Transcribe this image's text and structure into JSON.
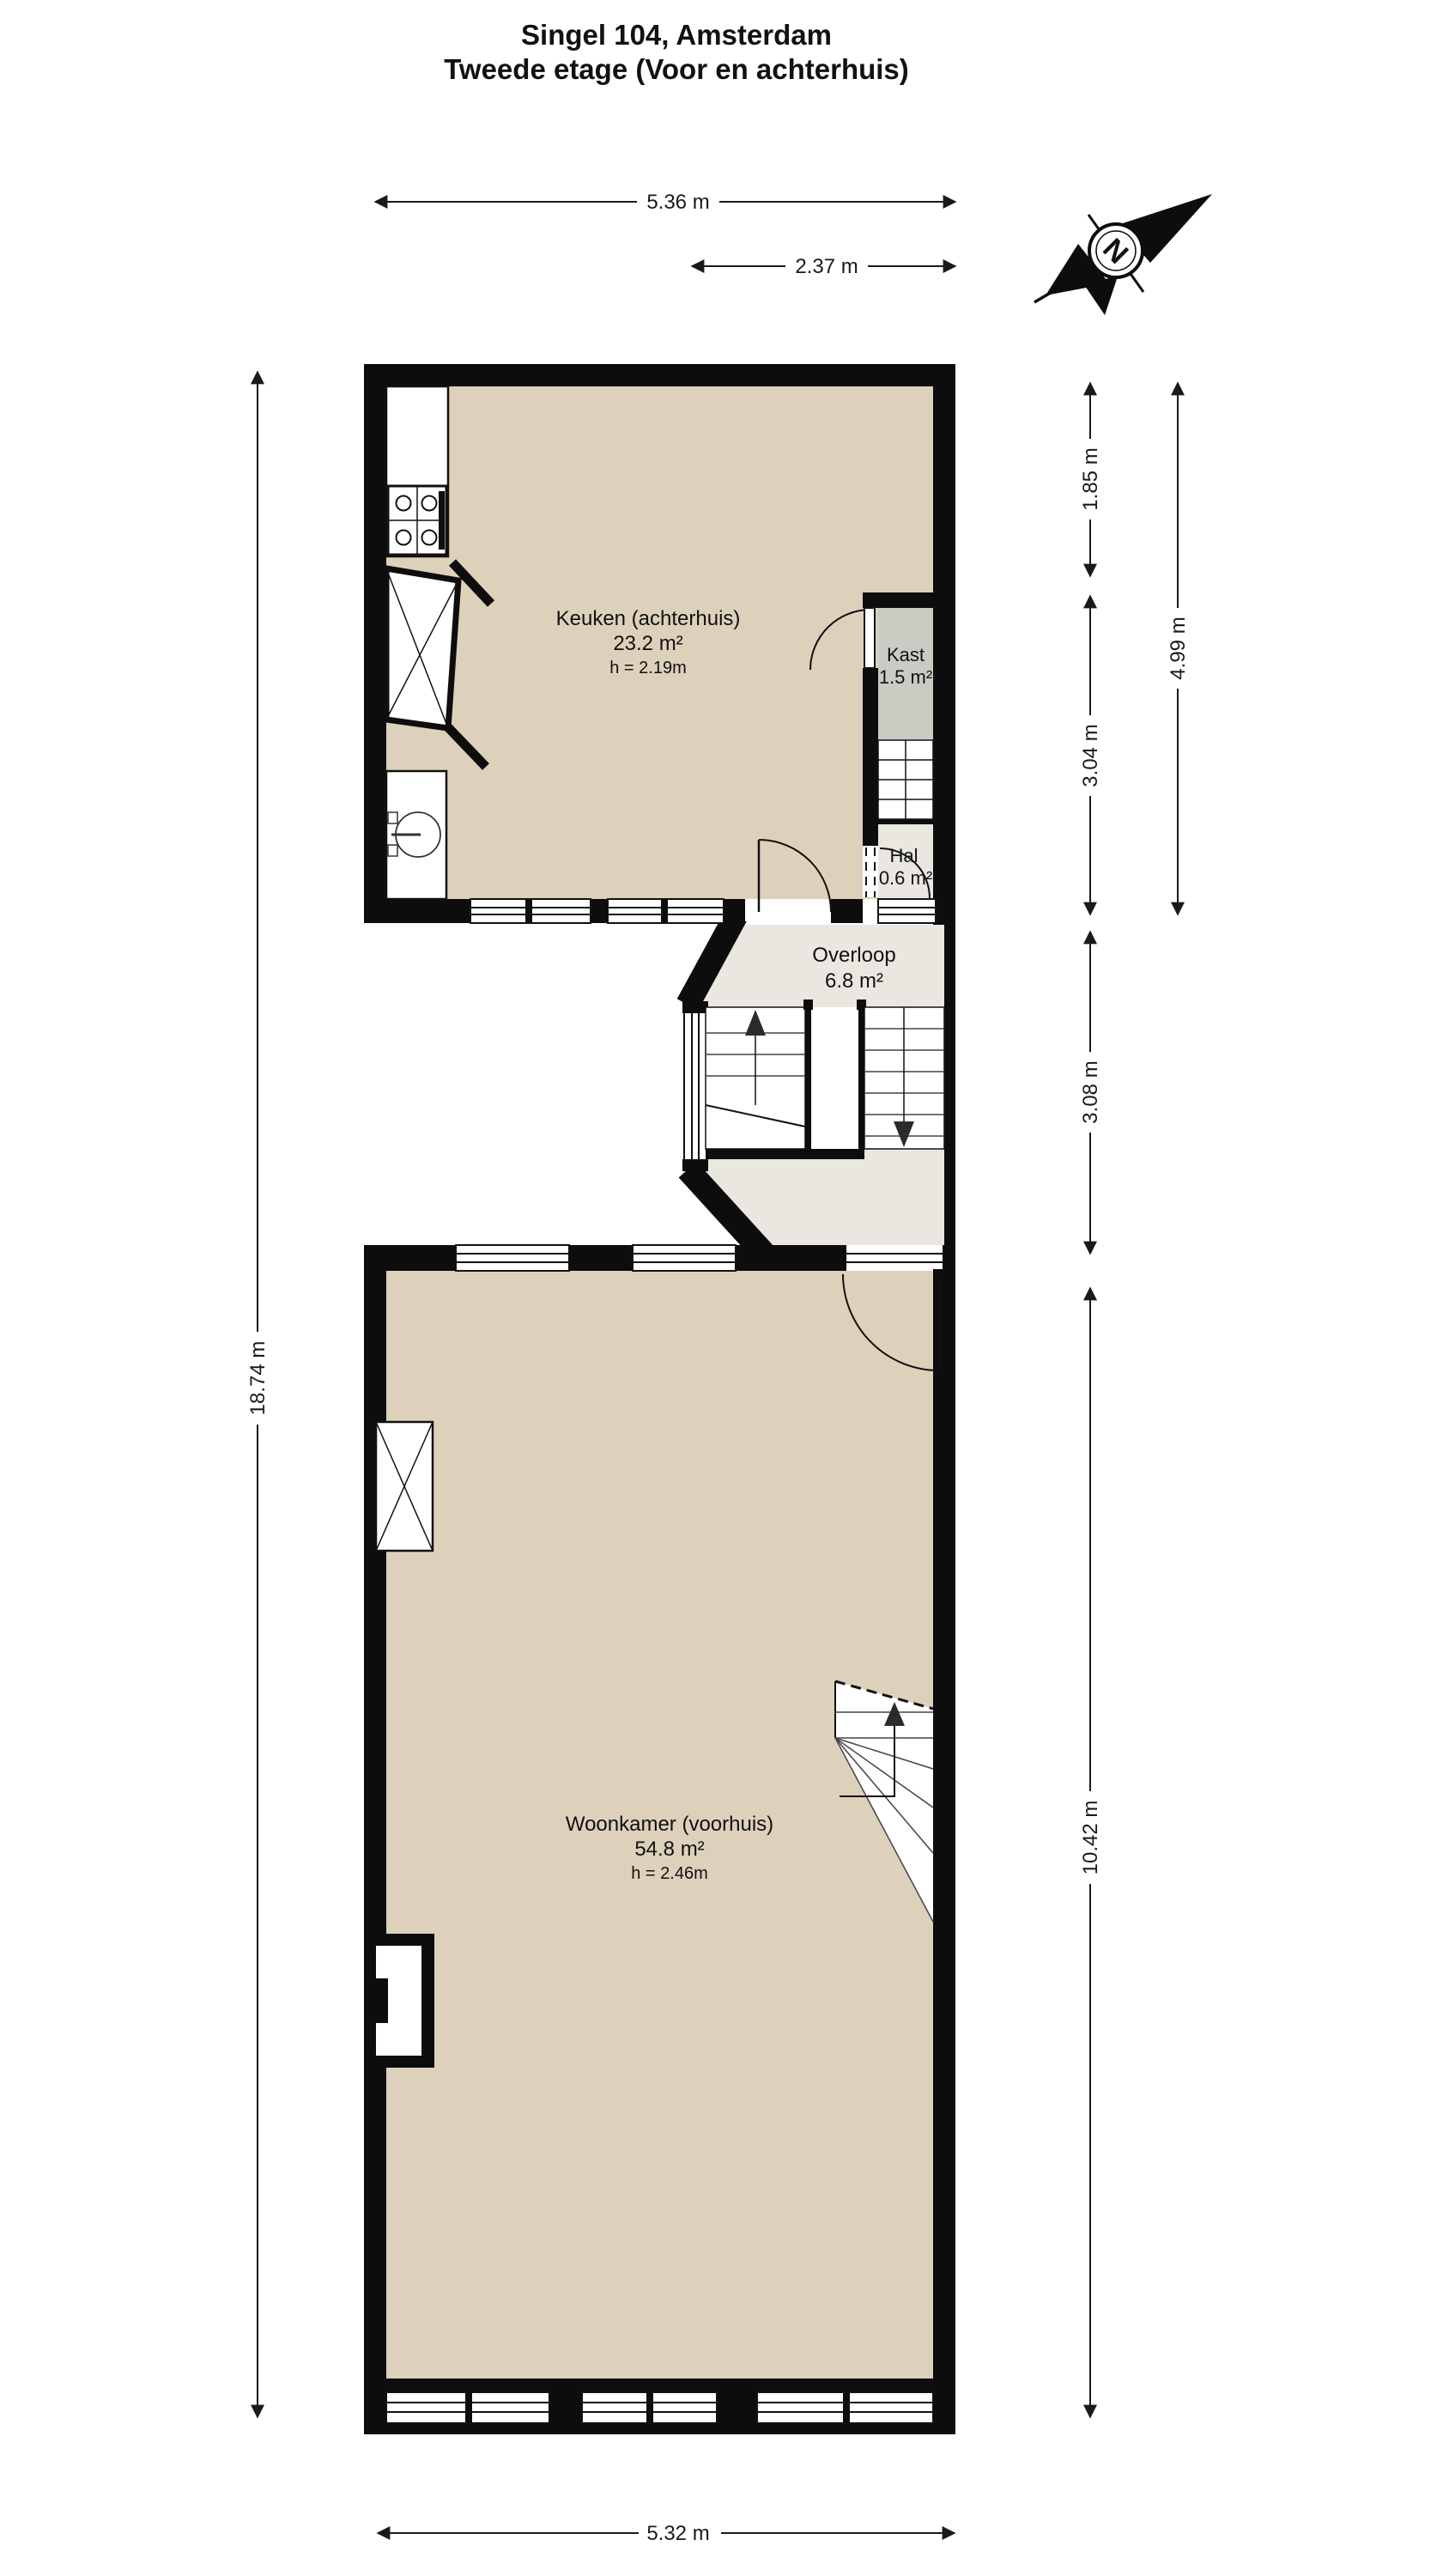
{
  "title": {
    "line1": "Singel 104, Amsterdam",
    "line2": "Tweede etage (Voor en achterhuis)"
  },
  "compass": {
    "north_letter": "N"
  },
  "rooms": {
    "keuken": {
      "name": "Keuken (achterhuis)",
      "area": "23.2 m²",
      "ceiling": "h = 2.19m"
    },
    "kast": {
      "name": "Kast",
      "area": "1.5 m²"
    },
    "hal": {
      "name": "Hal",
      "area": "0.6 m²"
    },
    "overloop": {
      "name": "Overloop",
      "area": "6.8 m²"
    },
    "woonkamer": {
      "name": "Woonkamer (voorhuis)",
      "area": "54.8 m²",
      "ceiling": "h = 2.46m"
    }
  },
  "dimensions": {
    "top_total": "5.36 m",
    "top_partial": "2.37 m",
    "right_inner_top": "1.85 m",
    "right_inner_mid": "3.04 m",
    "right_outer": "4.99 m",
    "right_overloop": "3.08 m",
    "right_woonkamer": "10.42 m",
    "left_total": "18.74 m",
    "bottom_total": "5.32 m"
  },
  "colors": {
    "floor_main": "#ddd1bc",
    "floor_closet": "#c9ccc2",
    "floor_landing": "#e9e7e0",
    "wall": "#0d0d0d"
  }
}
